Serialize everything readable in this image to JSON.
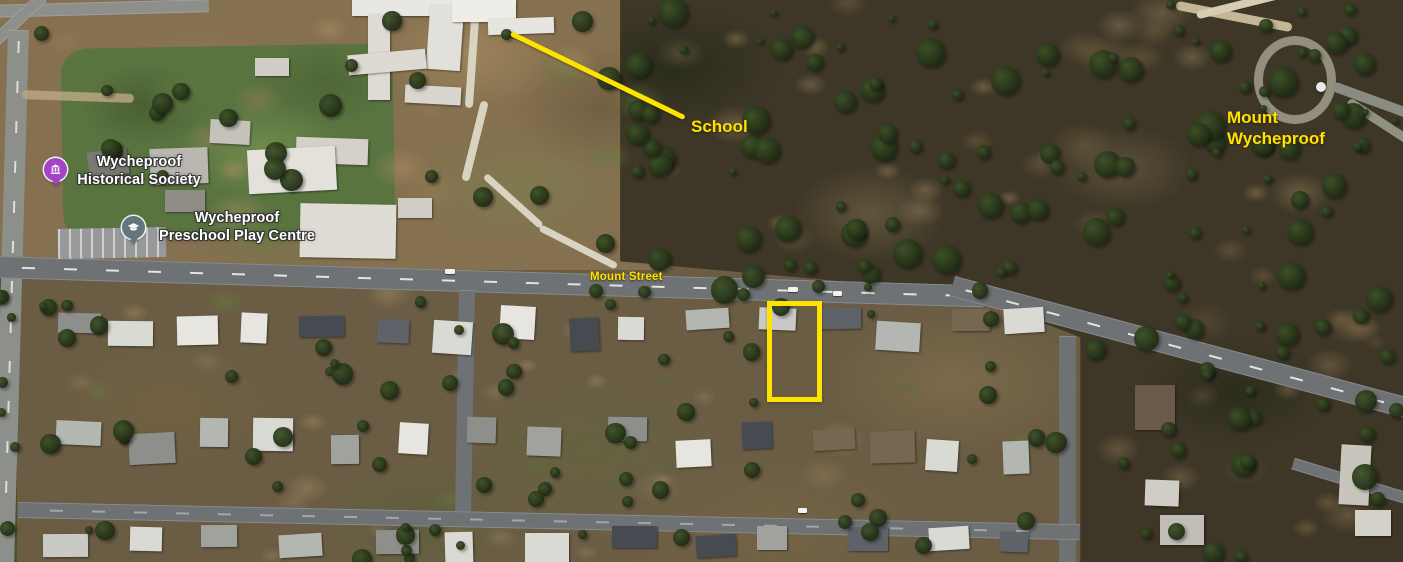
{
  "annotations": {
    "school": {
      "label": "School"
    },
    "mount": {
      "line1": "Mount",
      "line2": "Wycheproof"
    },
    "street": {
      "label": "Mount Street"
    },
    "highlight_color": "#FFE300"
  },
  "pois": {
    "historical_society": {
      "line1": "Wycheproof",
      "line2": "Historical Society",
      "icon": "museum-icon",
      "pin_color": "#A344C6"
    },
    "preschool": {
      "line1": "Wycheproof",
      "line2": "Preschool Play Centre",
      "icon": "graduation-cap-icon",
      "pin_color": "#64757E"
    }
  }
}
